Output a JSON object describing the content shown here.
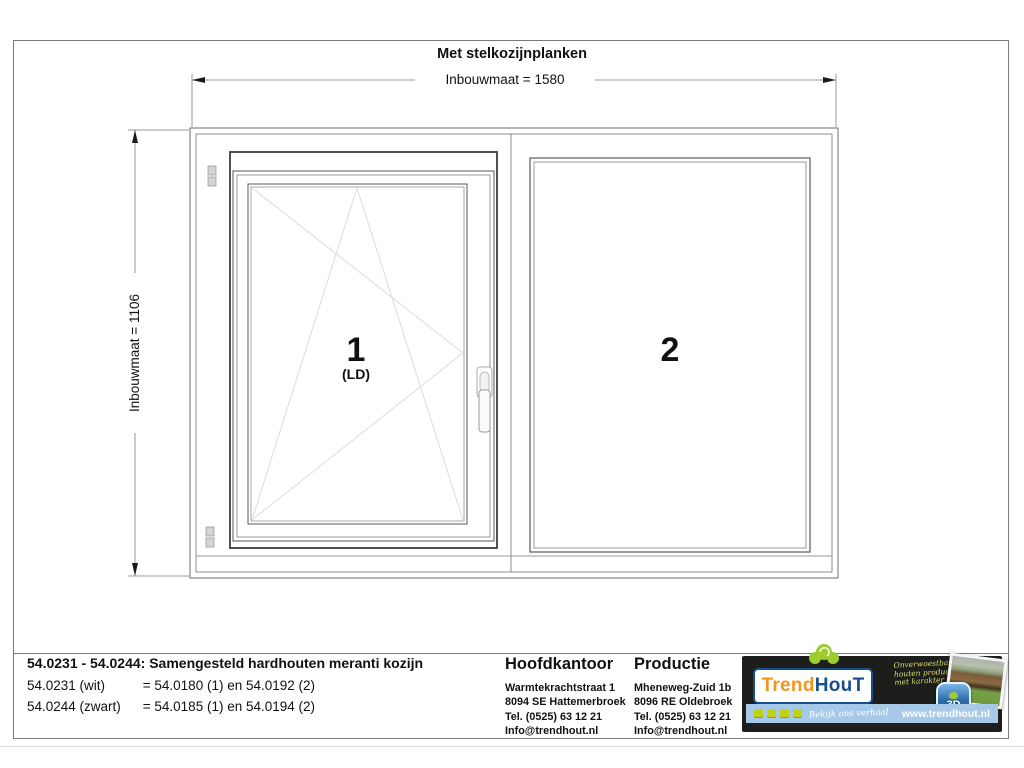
{
  "title": "Met stelkozijnplanken",
  "dimensions": {
    "width": "Inbouwmaat = 1580",
    "height": "Inbouwmaat = 1106"
  },
  "panels": [
    {
      "number": "1",
      "type_label": "(LD)"
    },
    {
      "number": "2"
    }
  ],
  "title_block": {
    "product_title": "54.0231 - 54.0244: Samengesteld hardhouten meranti kozijn",
    "variants": [
      {
        "code": "54.0231 (wit)",
        "mapping": "= 54.0180 (1) en 54.0192 (2)"
      },
      {
        "code": "54.0244 (zwart)",
        "mapping": "= 54.0185 (1) en 54.0194 (2)"
      }
    ],
    "hoofdkantoor": {
      "heading": "Hoofdkantoor",
      "address_lines": [
        "Warmtekrachtstraat 1",
        "8094 SE Hattemerbroek",
        "Tel. (0525) 63 12 21",
        "Info@trendhout.nl"
      ]
    },
    "productie": {
      "heading": "Productie",
      "address_lines": [
        "Mheneweg-Zuid 1b",
        "8096 RE Oldebroek",
        "Tel. (0525) 63 12 21",
        "Info@trendhout.nl"
      ]
    }
  },
  "logo": {
    "brand_part1": "Trend",
    "brand_part2": "HouT",
    "tagline_lines": [
      "Onverwoestbare",
      "houten producten",
      "met karakter"
    ],
    "badge_text": "3D",
    "cta_text": "Bekijk ons verhaal",
    "website": "www.trendhout.nl"
  },
  "colors": {
    "brand_orange": "#f7941d",
    "brand_blue": "#164f8c",
    "brand_green": "#9ecb2d",
    "bar_lightblue": "#a6c9e8",
    "social_yellowgreen": "#c0d212",
    "logo_background": "#1d1d1b",
    "drawing_line_gray": "#6e6e6e",
    "opening_line_light": "#dcdcdc"
  }
}
